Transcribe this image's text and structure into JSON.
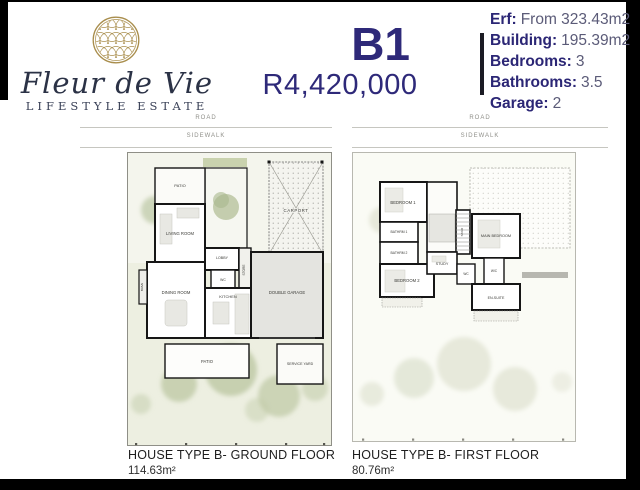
{
  "header": {
    "brand": {
      "script": "Fleur de Vie",
      "subtitle": "LIFESTYLE ESTATE",
      "emblem_icon": "flower-of-life-icon"
    },
    "unit_code": "B1",
    "price": "R4,420,000",
    "specs": [
      {
        "label": "Erf:",
        "value": "From 323.43m2"
      },
      {
        "label": "Building:",
        "value": "195.39m2"
      },
      {
        "label": "Bedrooms:",
        "value": "3"
      },
      {
        "label": "Bathrooms:",
        "value": "3.5"
      },
      {
        "label": "Garage:",
        "value": "2"
      }
    ]
  },
  "plans": {
    "ground": {
      "road_label": "ROAD",
      "sidewalk_label": "SIDEWALK",
      "rooms": {
        "patio_top": "PATIO",
        "living_room": "LIVING ROOM",
        "lobby": "LOBBY",
        "wc": "WC",
        "store": "STORE",
        "carport": "CARPORT",
        "dining_room": "DINING ROOM",
        "kitchen": "KITCHEN",
        "braai": "BRAAI",
        "double_garage": "DOUBLE GARAGE",
        "patio_bottom": "PATIO",
        "service_yard": "SERVICE YARD"
      },
      "caption_title": "HOUSE TYPE B- GROUND FLOOR",
      "caption_area": "114.63m²"
    },
    "first": {
      "road_label": "ROAD",
      "sidewalk_label": "SIDEWALK",
      "rooms": {
        "bedroom_1": "BEDROOM 1",
        "bathrm_1": "BATHRM 1",
        "bathrm_2": "BATHRM 2",
        "bedroom_2": "BEDROOM 2",
        "study": "STUDY",
        "stair": "STAIR",
        "main_bedroom": "MAIN BEDROOM",
        "wc": "WC",
        "wc_2": "W/C",
        "en_suite": "EN-SUITE"
      },
      "caption_title": "HOUSE TYPE B- FIRST FLOOR",
      "caption_area": "80.76m²"
    }
  },
  "colors": {
    "brand_navy": "#2e2979",
    "brand_gold": "#a98e4d",
    "garden_green": "#edefe1",
    "frame_black": "#000000"
  }
}
